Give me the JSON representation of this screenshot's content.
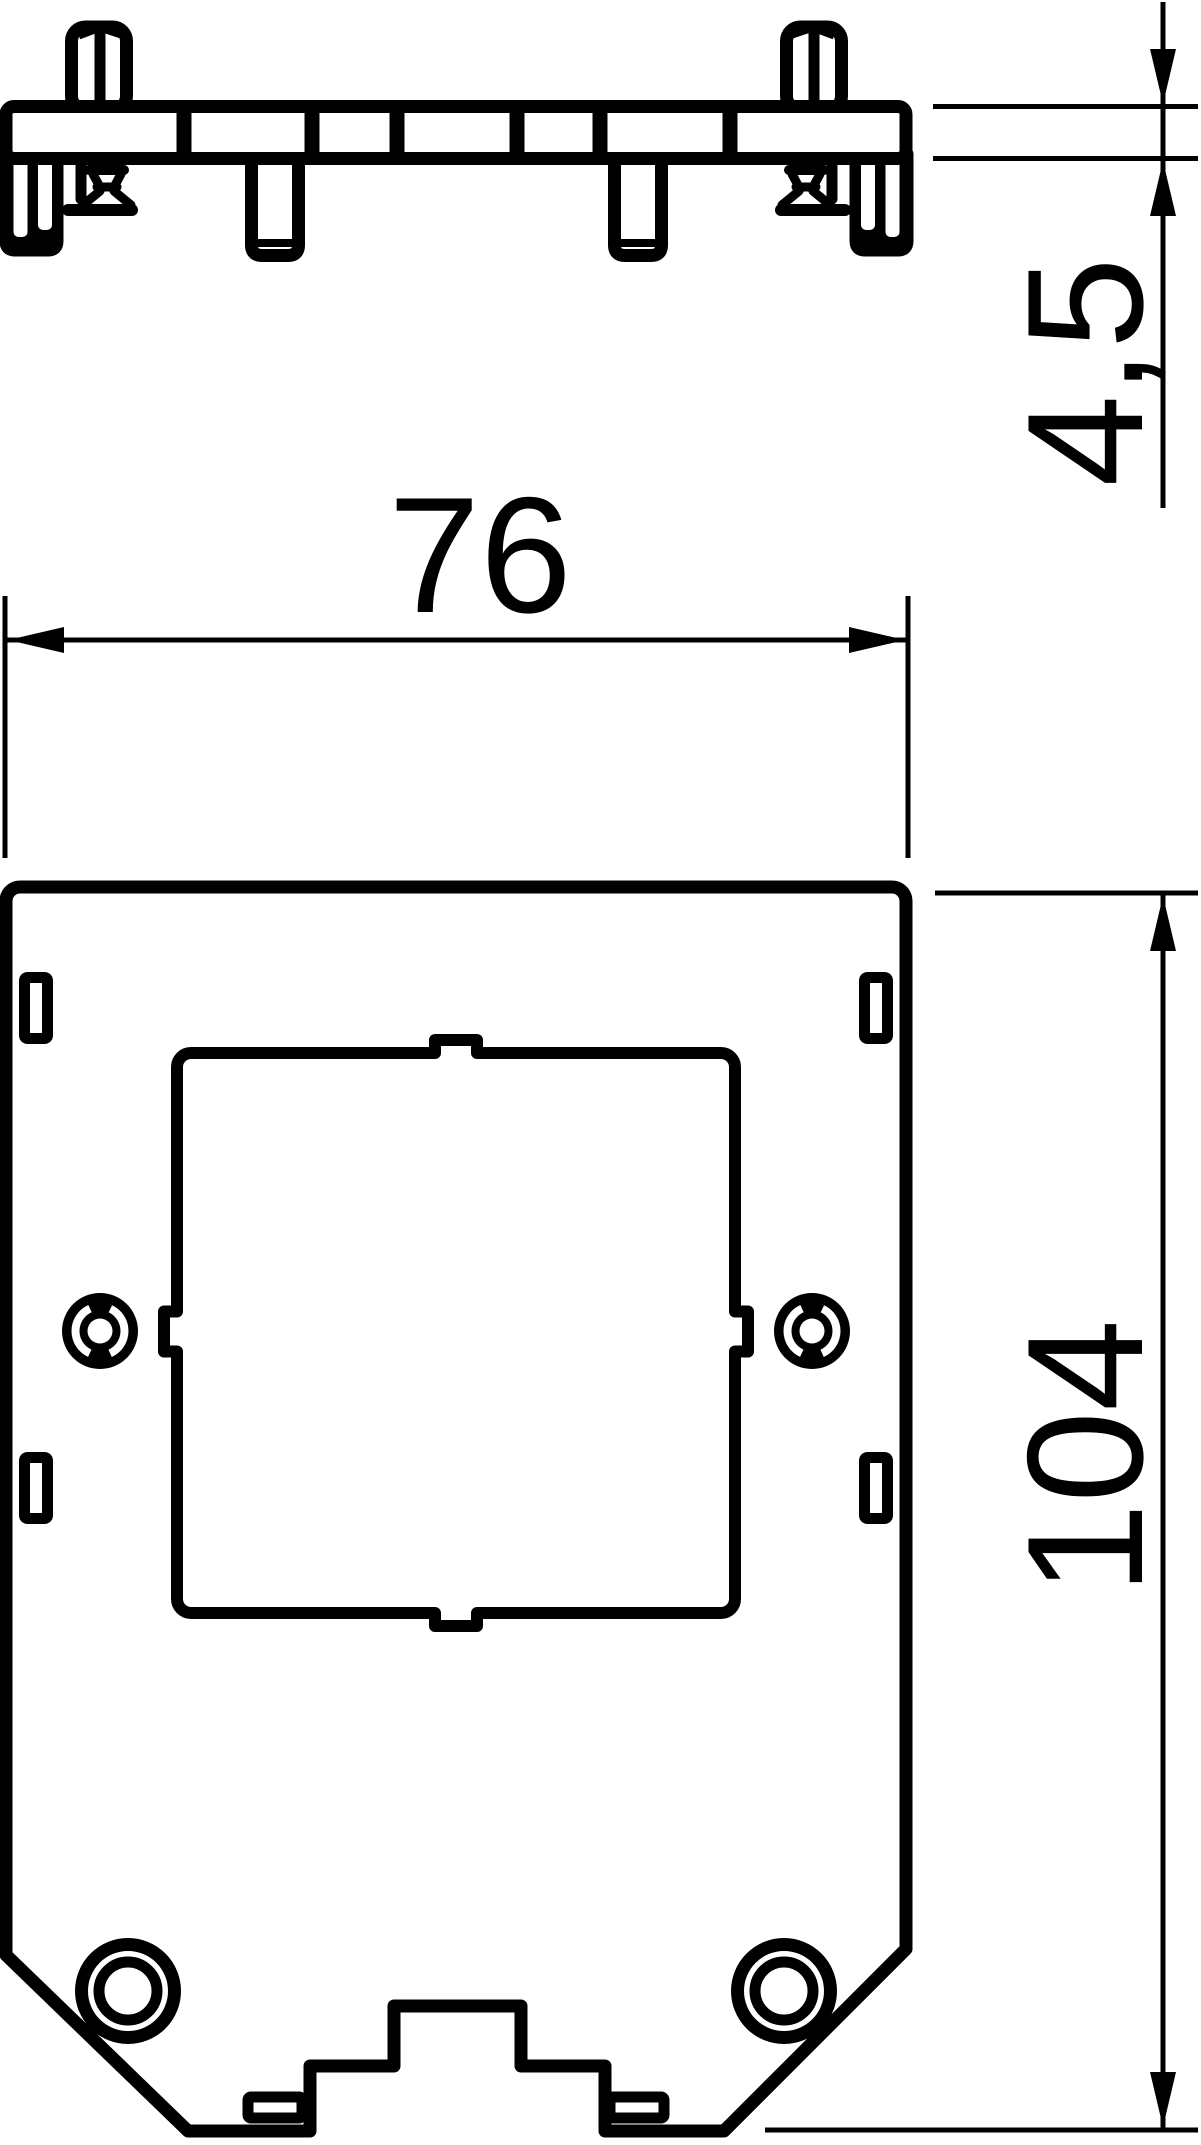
{
  "drawing": {
    "kind": "technical-dimension-drawing",
    "colors": {
      "line": "#000000",
      "background": "#ffffff"
    },
    "dimensions": {
      "width_label": "76",
      "height_label": "104",
      "thickness_label": "4,5"
    }
  }
}
